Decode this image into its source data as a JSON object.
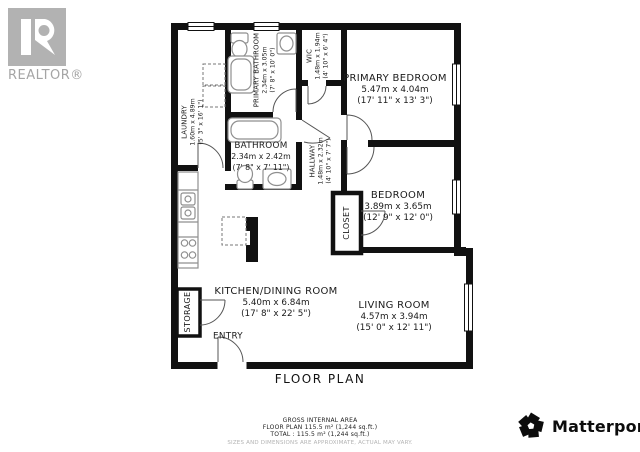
{
  "title": "FLOOR PLAN",
  "branding": {
    "realtor_logo_text": "REALTOR®",
    "matterport_text": "Matterport",
    "matterport_mark": "®"
  },
  "colors": {
    "wall": "#111111",
    "fixture": "#8f8f8f",
    "door": "#555555",
    "label": "#1b1b1b",
    "logo_gray": "#b2b2b2"
  },
  "rooms": {
    "laundry": {
      "name": "LAUNDRY",
      "metric": "1.60m x 4.89m",
      "imperial": "(5' 3\" x 16' 1\")"
    },
    "primary_bathroom": {
      "name": "PRIMARY BATHROOM",
      "metric": "2.34m x 3.05m",
      "imperial": "(7' 8\" x 10' 0\")"
    },
    "wic": {
      "name": "WIC",
      "metric": "1.48m x 1.94m",
      "imperial": "(4' 10\" x 6' 4\")"
    },
    "primary_bedroom": {
      "name": "PRIMARY BEDROOM",
      "metric": "5.47m x 4.04m",
      "imperial": "(17' 11\" x 13' 3\")"
    },
    "bathroom": {
      "name": "BATHROOM",
      "metric": "2.34m x 2.42m",
      "imperial": "(7' 8\" x 7' 11\")"
    },
    "hallway": {
      "name": "HALLWAY",
      "metric": "1.48m x 2.32m",
      "imperial": "(4' 10\" x 7' 7\")"
    },
    "bedroom": {
      "name": "BEDROOM",
      "metric": "3.89m x 3.65m",
      "imperial": "(12' 9\" x 12' 0\")"
    },
    "closet": {
      "name": "CLOSET"
    },
    "kitchen_dining": {
      "name": "KITCHEN/DINING ROOM",
      "metric": "5.40m x 6.84m",
      "imperial": "(17' 8\" x 22' 5\")"
    },
    "storage": {
      "name": "STORAGE"
    },
    "entry": {
      "name": "ENTRY"
    },
    "living_room": {
      "name": "LIVING ROOM",
      "metric": "4.57m x 3.94m",
      "imperial": "(15' 0\" x 12' 11\")"
    }
  },
  "footer": {
    "line1": "GROSS INTERNAL AREA",
    "line2": "FLOOR PLAN 115.5 m² (1,244 sq.ft.)",
    "line3": "TOTAL :  115.5 m² (1,244 sq.ft.)",
    "disclaimer": "SIZES AND DIMENSIONS ARE APPROXIMATE, ACTUAL MAY VARY."
  }
}
